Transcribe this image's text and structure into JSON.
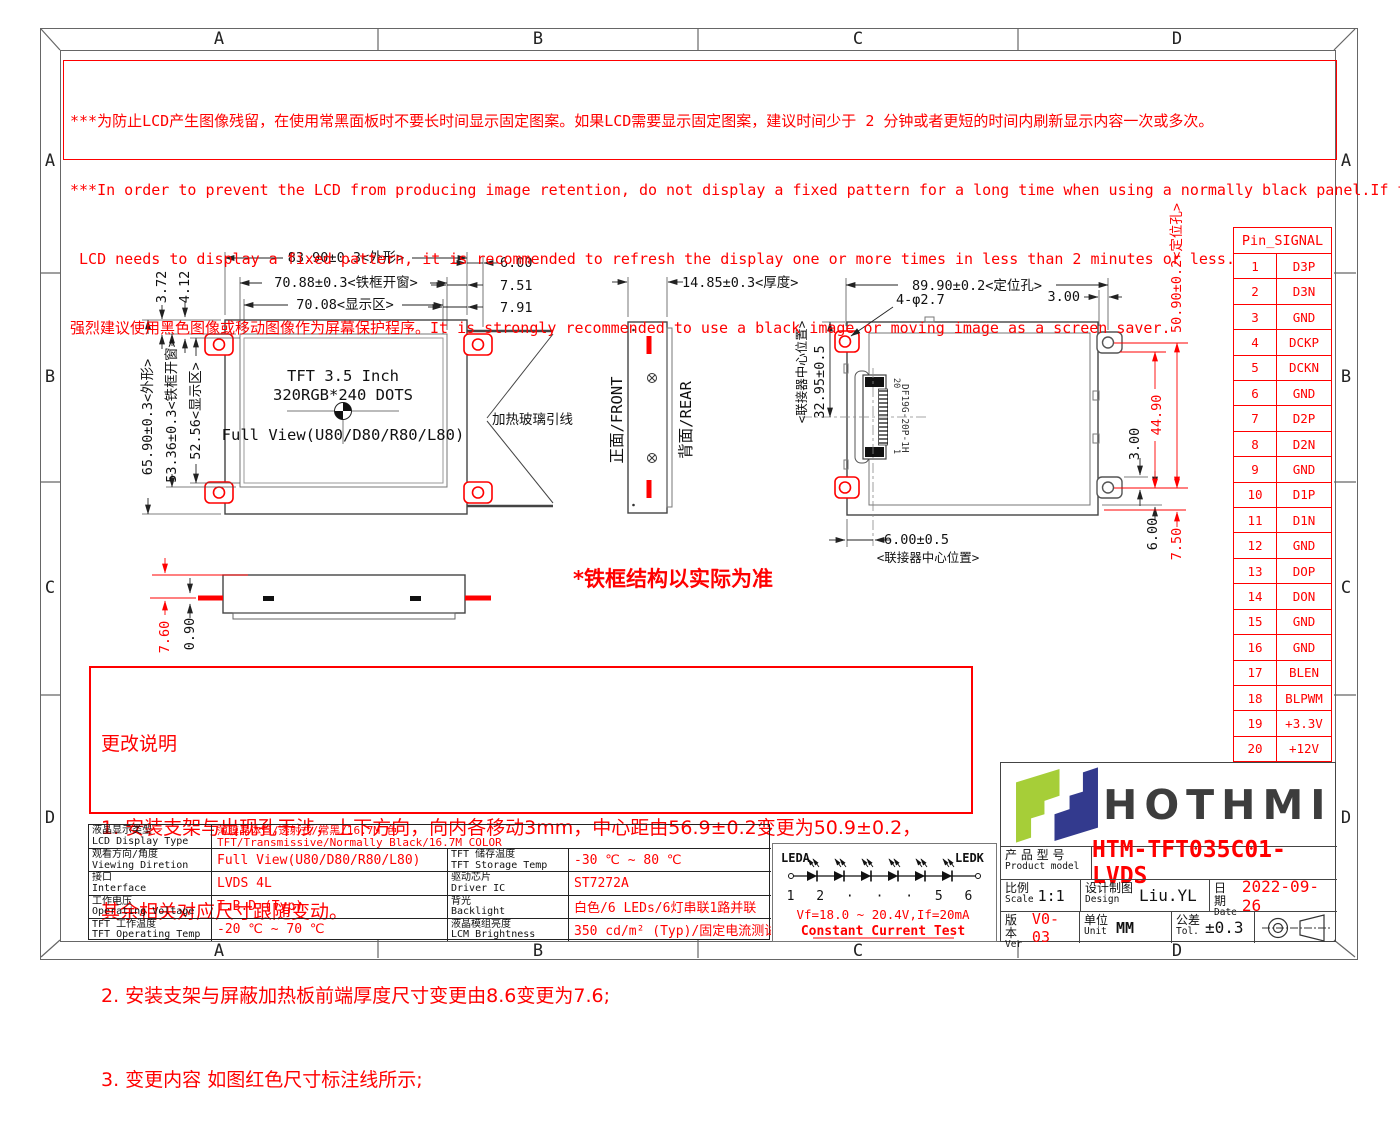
{
  "zones": {
    "cols": [
      "A",
      "B",
      "C",
      "D"
    ],
    "rows": [
      "A",
      "B",
      "C",
      "D"
    ]
  },
  "warning": {
    "lines": [
      "***为防止LCD产生图像残留，在使用常黑面板时不要长时间显示固定图案。如果LCD需要显示固定图案，建议时间少于 2 分钟或者更短的时间内刷新显示内容一次或多次。",
      "***In order to prevent the LCD from producing image retention, do not display a fixed pattern for a long time when using a normally black panel.If the",
      " LCD needs to display a fixed pattern, it is recommended to refresh the display one or more times in less than 2 minutes or less.",
      "强烈建议使用黑色图像或移动图像作为屏幕保护程序。It is strongly recommended to use a black image or moving image as a screen saver."
    ]
  },
  "front_view": {
    "dim_w_outline": "83.90±0.3<外形>",
    "dim_w_bezel": "70.88±0.3<铁框开窗>",
    "dim_w_active": "70.08<显示区>",
    "dim_r1": "6.00",
    "dim_r2": "7.51",
    "dim_r3": "7.91",
    "dim_t1": "3.72",
    "dim_t2": "4.12",
    "dim_h_outline": "65.90±0.3<外形>",
    "dim_h_bezel": "53.36±0.3<铁框开窗>",
    "dim_h_active": "52.56<显示区>",
    "line1": "TFT 3.5 Inch",
    "line2": "320RGB*240 DOTS",
    "line3": "Full View(U80/D80/R80/L80)",
    "heater_label": "加热玻璃引线"
  },
  "side_view": {
    "dim_thickness": "14.85±0.3<厚度>",
    "front_label": "正面/FRONT",
    "rear_label": "背面/REAR"
  },
  "rear_view": {
    "dim_top": "89.90±0.2<定位孔>",
    "dim_holes": "4-φ2.7",
    "dim_top_right": "3.00",
    "connector_center_v_label": "<联接器中心位置>",
    "dim_connector_v": "32.95±0.5",
    "dim_connector_h": "6.00±0.5",
    "connector_center_h_label": "<联接器中心位置>",
    "dim_right_red_1": "50.90±0.2<定位孔>",
    "dim_right_red_2": "44.90",
    "dim_right_3": "3.00",
    "dim_right_4": "6.00",
    "dim_right_red_5": "7.50",
    "connector_label": "DF19G-20P-1H",
    "connector_pin_top": "20",
    "connector_pin_bottom": "1"
  },
  "bottom_view": {
    "dim_red": "7.60",
    "dim_black": "0.90"
  },
  "frame_note": "*铁框结构以实际为准",
  "change_notes": {
    "title": "更改说明",
    "line1": "1. 安装支架与出现孔干涉，上下方向，向内各移动3mm，中心距由56.9±0.2变更为50.9±0.2，",
    "line2": "其余相关对应尺寸跟随变动。",
    "line3": "2. 安装支架与屏蔽加热板前端厚度尺寸变更由8.6变更为7.6;",
    "line4": "3. 变更内容 如图红色尺寸标注线所示;"
  },
  "spec_table": {
    "r1_label_cn": "液晶显示类型",
    "r1_label_en": "LCD Display Type",
    "r1_value_cn": "薄膜晶体管/透射式/常黑/16.7M 色",
    "r1_value_en": "TFT/Transmissive/Normally Black/16.7M COLOR",
    "r2_label_cn": "观看方向/角度",
    "r2_label_en": "Viewing Diretion",
    "r2_value": "Full View(U80/D80/R80/L80)",
    "r2_label2_cn": "TFT 储存温度",
    "r2_label2_en": "TFT Storage Temp",
    "r2_value2": "-30 ℃ ~ 80 ℃",
    "r3_label_cn": "接口",
    "r3_label_en": "Interface",
    "r3_value": "LVDS 4L",
    "r3_label2_cn": "驱动芯片",
    "r3_label2_en": "Driver IC",
    "r3_value2": "ST7272A",
    "r4_label_cn": "工作电压",
    "r4_label_en": "Operating Voltage",
    "r4_value": "T.B.D (Typ)",
    "r4_label2_cn": "背光",
    "r4_label2_en": "Backlight",
    "r4_value2": "白色/6 LEDs/6灯串联1路并联",
    "r5_label_cn": "TFT 工作温度",
    "r5_label_en": "TFT Operating Temp",
    "r5_value": "-20 ℃ ~ 70 ℃",
    "r5_label2_cn": "液晶模组亮度",
    "r5_label2_en": "LCM Brightness",
    "r5_value2": "350 cd/m² (Typ)/固定电流测试"
  },
  "led_circuit": {
    "anode": "LEDA",
    "cathode": "LEDK",
    "numbers": "1 2 · · · 5 6",
    "spec": "Vf=18.0 ~ 20.4V,If=20mA",
    "note": "Constant Current Test"
  },
  "pin_table": {
    "header": "Pin_SIGNAL",
    "rows": [
      [
        "1",
        "D3P"
      ],
      [
        "2",
        "D3N"
      ],
      [
        "3",
        "GND"
      ],
      [
        "4",
        "DCKP"
      ],
      [
        "5",
        "DCKN"
      ],
      [
        "6",
        "GND"
      ],
      [
        "7",
        "D2P"
      ],
      [
        "8",
        "D2N"
      ],
      [
        "9",
        "GND"
      ],
      [
        "10",
        "D1P"
      ],
      [
        "11",
        "D1N"
      ],
      [
        "12",
        "GND"
      ],
      [
        "13",
        "DOP"
      ],
      [
        "14",
        "DON"
      ],
      [
        "15",
        "GND"
      ],
      [
        "16",
        "GND"
      ],
      [
        "17",
        "BLEN"
      ],
      [
        "18",
        "BLPWM"
      ],
      [
        "19",
        "+3.3V"
      ],
      [
        "20",
        "+12V"
      ]
    ]
  },
  "title_block": {
    "brand": "HOTHMI",
    "product_label_cn": "产 品 型 号",
    "product_label_en": "Product model",
    "product_model": "HTM-TFT035C01-LVDS",
    "scale_cn": "比例",
    "scale_en": "Scale",
    "scale_value": "1:1",
    "design_cn": "设计制图",
    "design_en": "Design",
    "design_value": "Liu.YL",
    "date_cn": "日期",
    "date_en": "Date",
    "date_value": "2022-09-26",
    "ver_cn": "版本",
    "ver_en": "Ver",
    "ver_value": "V0-03",
    "unit_cn": "单位",
    "unit_en": "Unit",
    "unit_value": "MM",
    "tol_cn": "公差",
    "tol_en": "Tol.",
    "tol_value": "±0.3"
  },
  "colors": {
    "accent_red": "#ff0000",
    "logo_green": "#a6ce38",
    "logo_navy": "#333a8e",
    "line": "#444444"
  }
}
